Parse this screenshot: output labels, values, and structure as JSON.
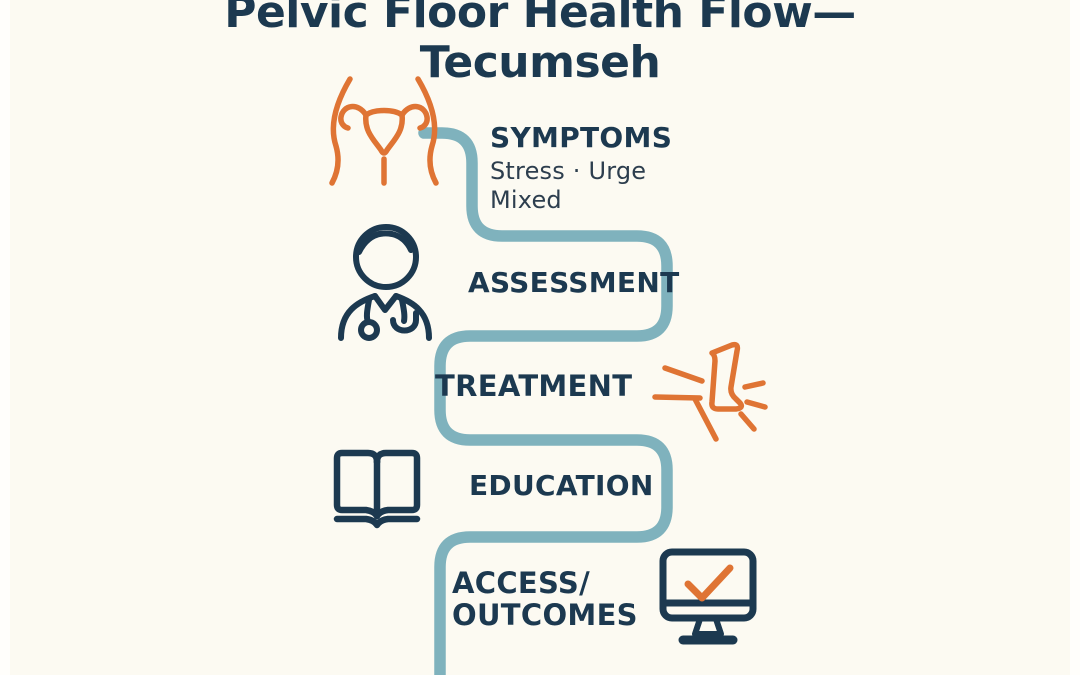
{
  "title": {
    "line1": "Pelvic Floor Health Flow—",
    "line2": "Tecumseh"
  },
  "flow": {
    "stages": [
      {
        "label": "SYMPTOMS",
        "details": [
          "Stress · Urge",
          "Mixed"
        ],
        "icon": "uterus-icon"
      },
      {
        "label": "ASSESSMENT",
        "icon": "doctor-icon"
      },
      {
        "label": "TREATMENT",
        "icon": "foot-impact-icon"
      },
      {
        "label": "EDUCATION",
        "icon": "open-book-icon"
      },
      {
        "label": "ACCESS/",
        "label_line2": "OUTCOMES",
        "icon": "monitor-check-icon"
      }
    ]
  },
  "colors": {
    "navy": "#1c3950",
    "orange": "#df7434",
    "teal": "#7fb2bd",
    "background": "#fcfaf2"
  }
}
